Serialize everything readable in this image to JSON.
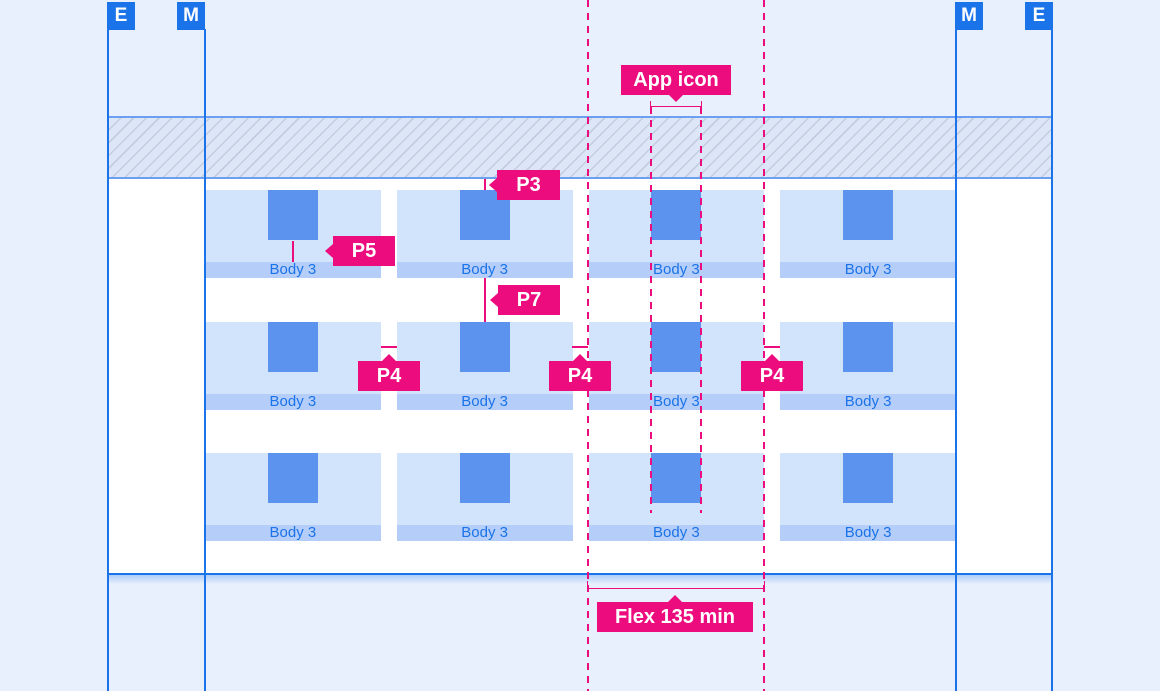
{
  "edge_markers": {
    "left": [
      "E",
      "M"
    ],
    "right": [
      "M",
      "E"
    ]
  },
  "annotations": {
    "app_icon": "App icon",
    "p3": "P3",
    "p5": "P5",
    "p7": "P7",
    "p4": [
      "P4",
      "P4",
      "P4"
    ],
    "flex": "Flex 135 min"
  },
  "grid": {
    "rows": [
      {
        "cells": [
          {
            "caption": "Body 3"
          },
          {
            "caption": "Body 3"
          },
          {
            "caption": "Body 3"
          },
          {
            "caption": "Body 3"
          }
        ]
      },
      {
        "cells": [
          {
            "caption": "Body 3"
          },
          {
            "caption": "Body 3"
          },
          {
            "caption": "Body 3"
          },
          {
            "caption": "Body 3"
          }
        ]
      },
      {
        "cells": [
          {
            "caption": "Body 3"
          },
          {
            "caption": "Body 3"
          },
          {
            "caption": "Body 3"
          },
          {
            "caption": "Body 3"
          }
        ]
      }
    ]
  },
  "colors": {
    "background": "#e8f0fe",
    "guide_blue": "#1a73e8",
    "annotation_pink": "#ec0c7e",
    "cell_fill": "#d2e3fc",
    "caption_bar_fill": "#b5cef9",
    "icon_fill": "#5b93ee"
  }
}
